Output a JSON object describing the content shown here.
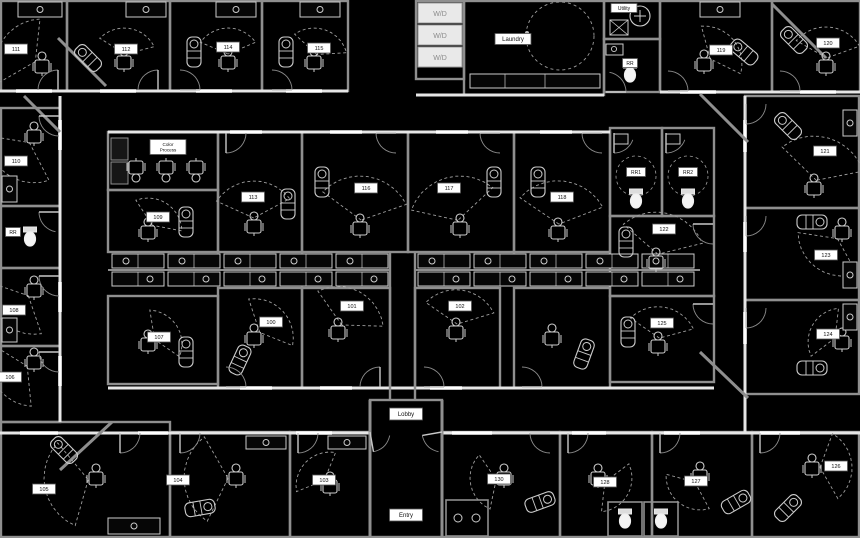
{
  "plan": {
    "title": "Salon suites floor plan",
    "colors": {
      "background": "#000000",
      "wall": "#8f8f8f",
      "wall_bright": "#e6e6e6",
      "wall_cap": "#ffffff",
      "furniture": "#cccccc",
      "dashed": "#9e9e9e",
      "label_bg": "#ffffff",
      "label_border": "#555555",
      "label_text": "#111111",
      "appliance_bg": "#e9e9e9",
      "appliance_text": "#8a8a8a",
      "dark_fill": "#161616"
    },
    "suites": [
      {
        "number": "111",
        "x": 16,
        "y": 49
      },
      {
        "number": "112",
        "x": 126,
        "y": 49
      },
      {
        "number": "114",
        "x": 228,
        "y": 47
      },
      {
        "number": "115",
        "x": 319,
        "y": 48
      },
      {
        "number": "119",
        "x": 721,
        "y": 50
      },
      {
        "number": "120",
        "x": 828,
        "y": 43
      },
      {
        "number": "110",
        "x": 16,
        "y": 161
      },
      {
        "number": "108",
        "x": 14,
        "y": 310
      },
      {
        "number": "106",
        "x": 10,
        "y": 377
      },
      {
        "number": "105",
        "x": 44,
        "y": 489
      },
      {
        "number": "104",
        "x": 178,
        "y": 480
      },
      {
        "number": "103",
        "x": 324,
        "y": 480
      },
      {
        "number": "130",
        "x": 499,
        "y": 479
      },
      {
        "number": "128",
        "x": 605,
        "y": 482
      },
      {
        "number": "127",
        "x": 696,
        "y": 481
      },
      {
        "number": "126",
        "x": 836,
        "y": 466
      },
      {
        "number": "124",
        "x": 828,
        "y": 334
      },
      {
        "number": "123",
        "x": 826,
        "y": 255
      },
      {
        "number": "121",
        "x": 825,
        "y": 151
      },
      {
        "number": "109",
        "x": 158,
        "y": 217
      },
      {
        "number": "113",
        "x": 253,
        "y": 197
      },
      {
        "number": "116",
        "x": 366,
        "y": 188
      },
      {
        "number": "117",
        "x": 449,
        "y": 188
      },
      {
        "number": "118",
        "x": 562,
        "y": 197
      },
      {
        "number": "122",
        "x": 664,
        "y": 229
      },
      {
        "number": "107",
        "x": 159,
        "y": 337
      },
      {
        "number": "100",
        "x": 271,
        "y": 322
      },
      {
        "number": "101",
        "x": 352,
        "y": 306
      },
      {
        "number": "102",
        "x": 460,
        "y": 306
      },
      {
        "number": "125",
        "x": 662,
        "y": 323
      }
    ],
    "areas": [
      {
        "name": "laundry",
        "text": "Laundry",
        "x": 513,
        "y": 39,
        "w": 36,
        "h": 11,
        "fs": 6
      },
      {
        "name": "utility",
        "text": "Utility",
        "x": 624,
        "y": 8,
        "w": 26,
        "h": 9,
        "fs": 5
      },
      {
        "name": "restroom-top",
        "text": "RR",
        "x": 630,
        "y": 63,
        "w": 15,
        "h": 9,
        "fs": 5
      },
      {
        "name": "restroom-left",
        "text": "RR",
        "x": 13,
        "y": 232,
        "w": 15,
        "h": 9,
        "fs": 5
      },
      {
        "name": "restroom-1",
        "text": "RR1",
        "x": 636,
        "y": 172,
        "w": 19,
        "h": 9,
        "fs": 5
      },
      {
        "name": "restroom-2",
        "text": "RR2",
        "x": 688,
        "y": 172,
        "w": 19,
        "h": 9,
        "fs": 5
      },
      {
        "name": "lobby",
        "text": "Lobby",
        "x": 406,
        "y": 414,
        "w": 33,
        "h": 12,
        "fs": 6
      },
      {
        "name": "entry",
        "text": "Entry",
        "x": 406,
        "y": 515,
        "w": 33,
        "h": 12,
        "fs": 6
      }
    ],
    "color_process": {
      "line1": "Color",
      "line2": "Process",
      "x": 168,
      "y": 147
    },
    "washer_dryer_units": [
      "W/D",
      "W/D",
      "W/D"
    ]
  }
}
